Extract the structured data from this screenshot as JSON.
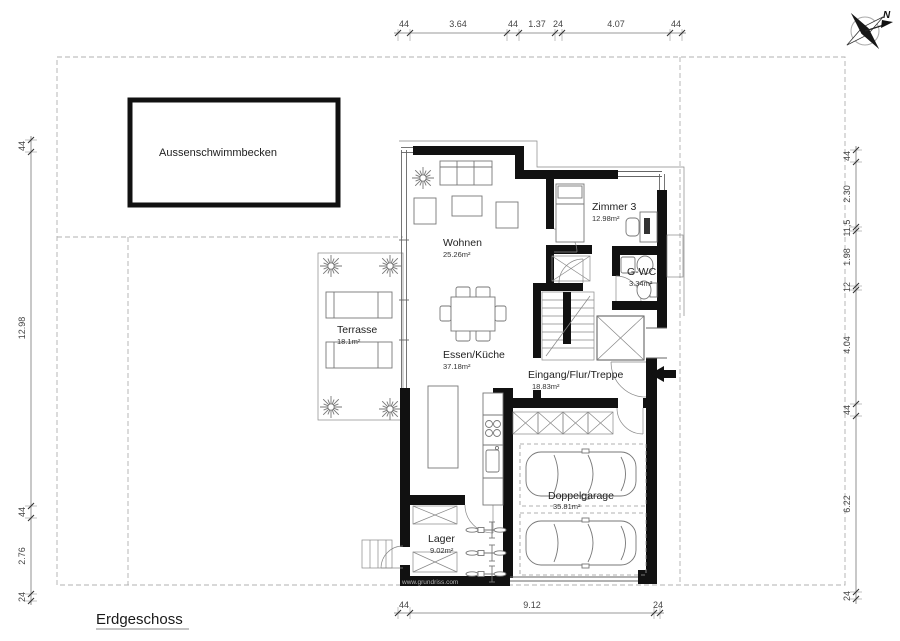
{
  "title": {
    "label": "Erdgeschoss"
  },
  "watermark": "www.grundriss.com",
  "compass": {
    "label": "N"
  },
  "rooms": {
    "pool": {
      "name": "Aussenschwimmbecken"
    },
    "wohnen": {
      "name": "Wohnen",
      "area": "25.26m²"
    },
    "zimmer3": {
      "name": "Zimmer 3",
      "area": "12.98m²"
    },
    "gwc": {
      "name": "G-WC",
      "area": "3.34m²"
    },
    "terrasse": {
      "name": "Terrasse",
      "area": "18.1m²"
    },
    "essen_kueche": {
      "name": "Essen/Küche",
      "area": "37.18m²"
    },
    "eingang": {
      "name": "Eingang/Flur/Treppe",
      "area": "18.83m²"
    },
    "doppelgarage": {
      "name": "Doppelgarage",
      "area": "35.81m²"
    },
    "lager": {
      "name": "Lager",
      "area": "9.02m²"
    }
  },
  "dimensions": {
    "top": [
      "44",
      "3.64",
      "44",
      "1.37",
      "24",
      "4.07",
      "44"
    ],
    "left": [
      "44",
      "12.98",
      "44",
      "2.76",
      "24"
    ],
    "right": [
      "44",
      "2.30",
      "11,5",
      "1.98",
      "12",
      "4.04",
      "44",
      "6.22",
      "24"
    ],
    "bottom": [
      "44",
      "9.12",
      "24"
    ]
  }
}
